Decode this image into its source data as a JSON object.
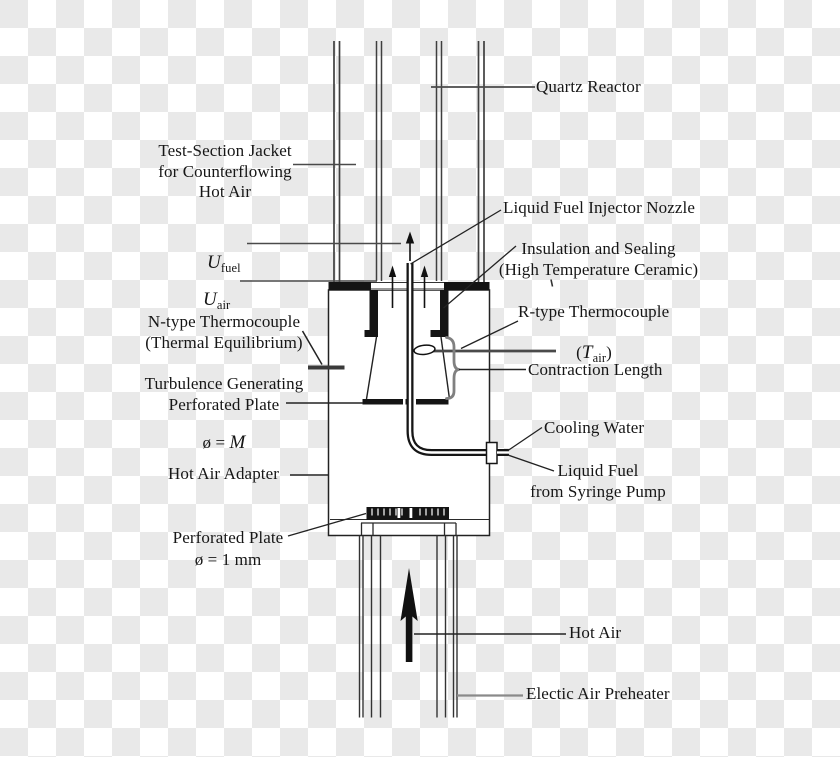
{
  "diagram": {
    "title_hint": "Burner / quartz reactor test rig schematic",
    "labels": {
      "quartz_reactor": "Quartz Reactor",
      "test_section_jacket": "Test-Section Jacket\nfor Counterflowing\nHot Air",
      "u_fuel": {
        "symbol": "U",
        "sub": "fuel"
      },
      "u_air": {
        "symbol": "U",
        "sub": "air"
      },
      "injector_nozzle": "Liquid Fuel Injector Nozzle",
      "insulation": "Insulation and Sealing\n(High Temperature Ceramic)",
      "n_type_thermocouple": "N-type Thermocouple\n(Thermal Equilibrium)",
      "r_type_thermocouple": "R-type Thermocouple",
      "r_type_symbol": {
        "paren_open": "(",
        "symbol": "T",
        "sub": "air",
        "paren_close": ")"
      },
      "contraction_length": "Contraction Length",
      "turbulence_plate": "Turbulence Generating\nPerforated Plate",
      "turbulence_plate_diameter": {
        "prefix": "ø = ",
        "value": "M"
      },
      "hot_air_adapter": "Hot Air Adapter",
      "cooling_water": "Cooling Water",
      "liquid_fuel_supply": "Liquid Fuel\nfrom Syringe Pump",
      "perforated_plate": "Perforated Plate\nø = 1 mm",
      "hot_air": "Hot Air",
      "air_preheater": "Electic Air Preheater"
    },
    "colors": {
      "line": "#1a1a1a",
      "soft_line": "#4a4a4a",
      "gray_line": "#8a8a8a",
      "checker": "#e9e9e9",
      "fill_black": "#141414",
      "white": "#ffffff"
    }
  }
}
